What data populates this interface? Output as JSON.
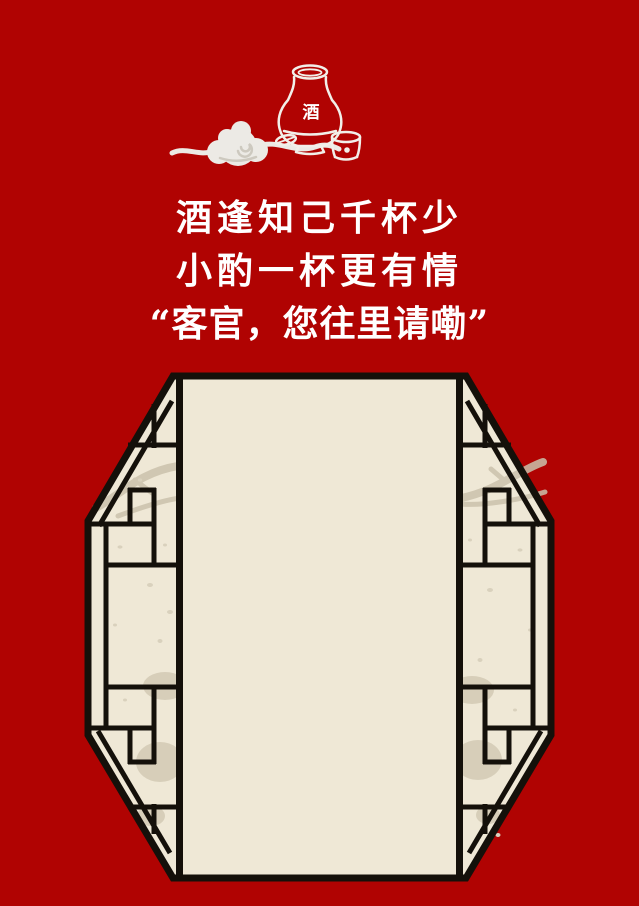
{
  "poster": {
    "verse": {
      "line1": "酒逢知己千杯少",
      "line2": "小酌一杯更有情",
      "line3": "“客官，您往里请嘞”"
    },
    "illustration": {
      "jug_label": "酒",
      "icons": [
        "wine-jug-icon",
        "wine-cup-icon",
        "auspicious-cloud-icon"
      ]
    },
    "window": {
      "kind": "octagonal-lattice-window"
    },
    "colors": {
      "background": "#b00302",
      "paper": "#efe8d6",
      "lattice_line": "#14100a",
      "shadow": "#cbc2ac",
      "cloud": "#eceae5",
      "text": "#ffffff"
    }
  }
}
